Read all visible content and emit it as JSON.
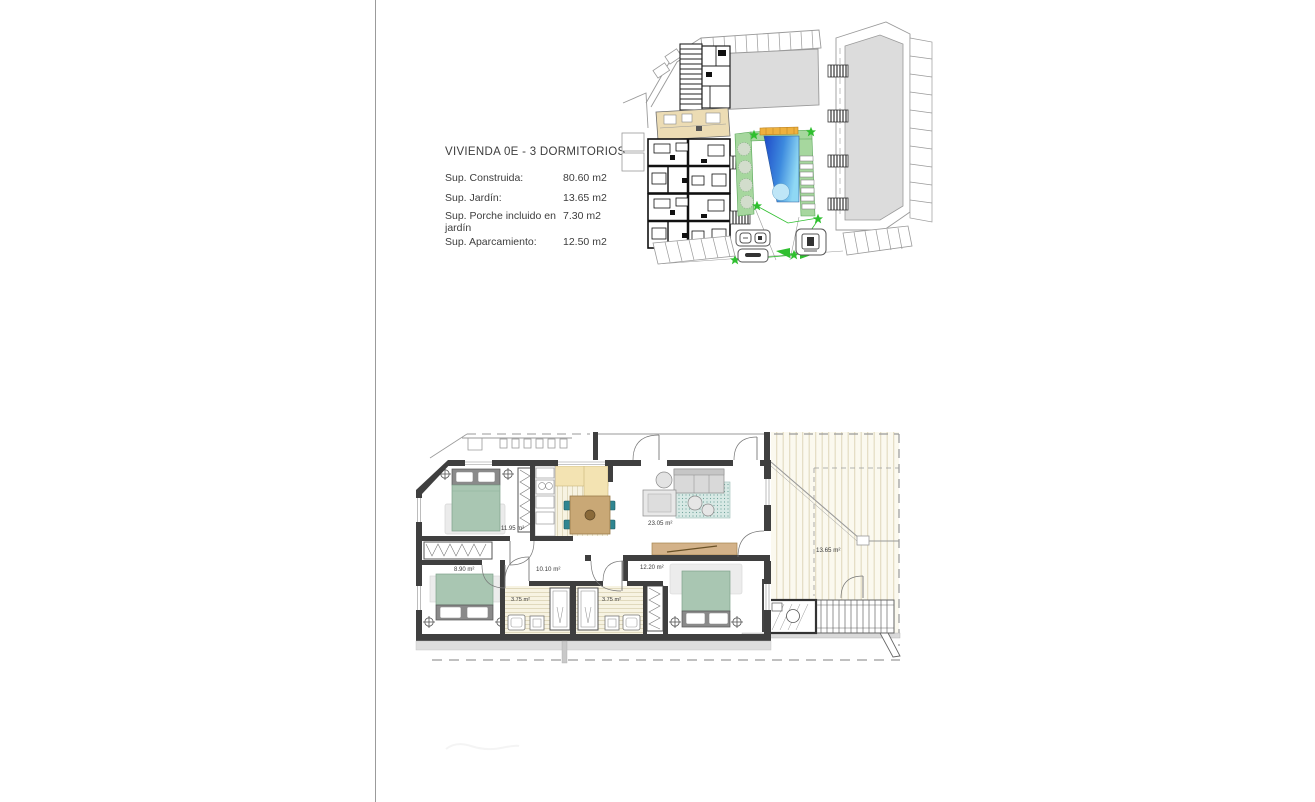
{
  "document": {
    "title_block": {
      "title": "VIVIENDA  0E - 3 DORMITORIOS",
      "rows": [
        {
          "label": "Sup. Construida:",
          "value": "80.60 m2"
        },
        {
          "label": "Sup. Jardín:",
          "value": "13.65 m2"
        },
        {
          "label": "Sup. Porche incluido en jardín",
          "value": "7.30 m2"
        },
        {
          "label": "Sup. Aparcamiento:",
          "value": "12.50 m2"
        }
      ]
    },
    "plan_labels": {
      "bedroom_main": "11.95 m²",
      "bedroom_left": "8.90 m²",
      "bedroom_right": "12.20 m²",
      "living": "23.05 m²",
      "hallway": "10.10 m²",
      "bath_left": "3.75 m²",
      "bath_right": "3.75 m²",
      "terrace": "13.65 m²"
    },
    "colors": {
      "wall_dark": "#3f3f3f",
      "building_gray": "#dcdcdc",
      "highlight_unit_beige": "#ecdcb4",
      "pool_blue_dark": "#1e49c8",
      "pool_blue_light": "#8fd8f4",
      "pool_edge_orange": "#eeb13e",
      "garden_green": "#a6d79e",
      "star_green": "#2fbf2f",
      "bed_green": "#a9c6b2",
      "counter_cream": "#f3e3b2",
      "table_wood": "#c9a876",
      "chair_teal": "#2f8591",
      "sideboard_tan": "#d3b289"
    }
  }
}
